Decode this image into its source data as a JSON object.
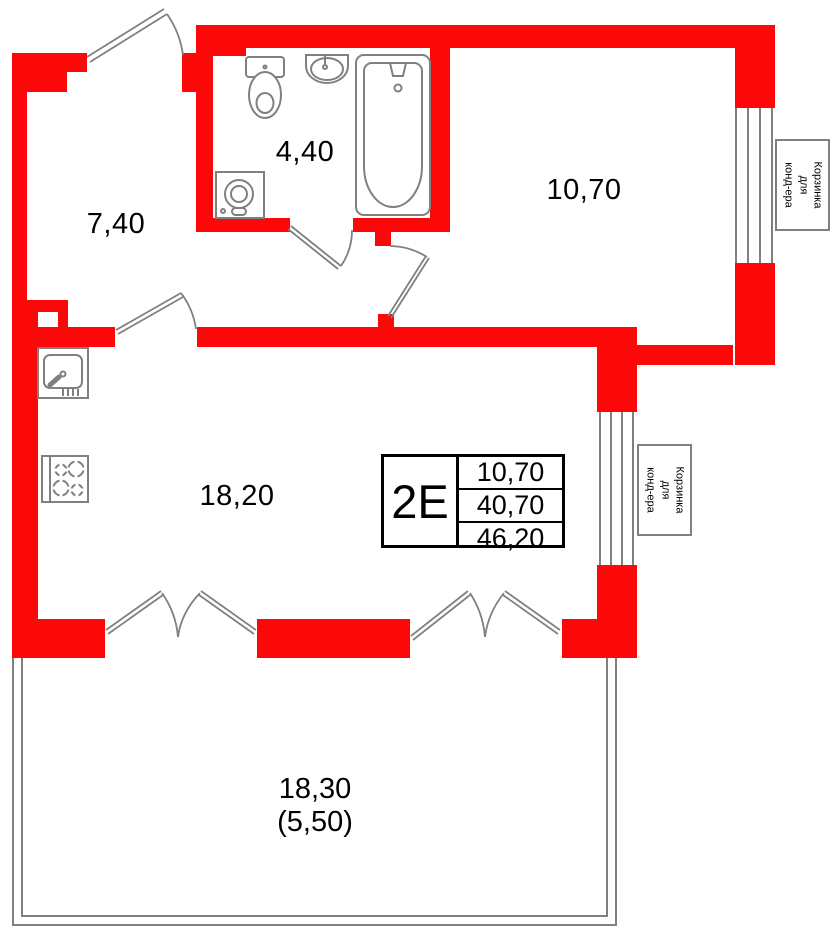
{
  "colors": {
    "wall_red": "#fd0808",
    "line_gray": "#808080",
    "text_black": "#000000"
  },
  "rooms": {
    "hall": {
      "area": "7,40"
    },
    "bathroom": {
      "area": "4,40"
    },
    "bedroom": {
      "area": "10,70"
    },
    "living_kitchen": {
      "area": "18,20"
    },
    "balcony": {
      "area": "18,30",
      "area_reduced": "(5,50)"
    }
  },
  "info_table": {
    "unit_label": "2E",
    "rows": [
      "10,70",
      "40,70",
      "46,20"
    ]
  },
  "ac_baskets": [
    {
      "label": "Корзинка\nдля\nконд-ера"
    },
    {
      "label": "Корзинка\nдля\nконд-ера"
    }
  ],
  "icons": [
    "toilet-icon",
    "bath-sink-icon",
    "bathtub-icon",
    "washing-machine-icon",
    "kitchen-sink-icon",
    "stove-icon",
    "window-icon",
    "door-swing-icon"
  ]
}
